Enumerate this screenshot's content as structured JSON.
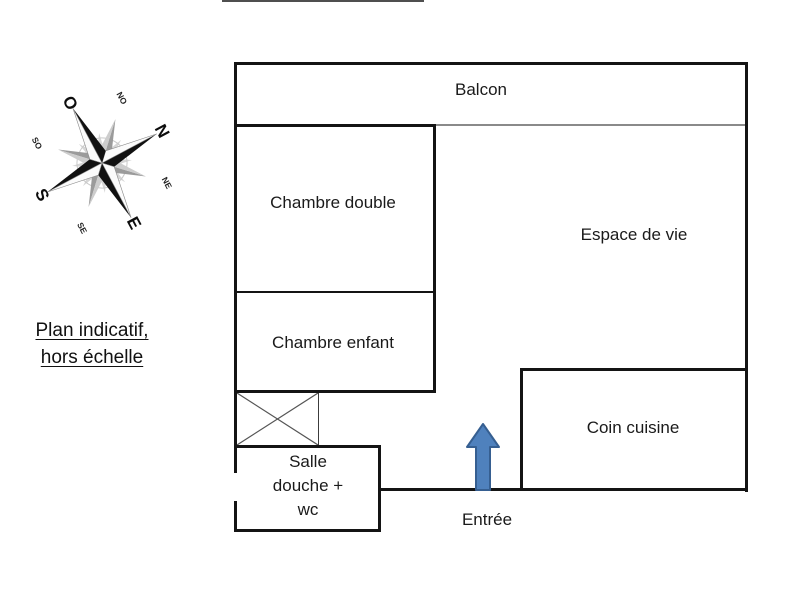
{
  "note": {
    "line1": "Plan indicatif,",
    "line2": "hors échelle"
  },
  "compass": {
    "cardinal": {
      "n": "N",
      "e": "E",
      "s": "S",
      "o": "O"
    },
    "intercardinal": {
      "no": "NO",
      "ne": "NE",
      "se": "SE",
      "so": "SO"
    }
  },
  "plan": {
    "rooms": {
      "balcon": "Balcon",
      "chambre_double": "Chambre double",
      "chambre_enfant": "Chambre enfant",
      "espace_de_vie": "Espace de vie",
      "coin_cuisine": "Coin cuisine",
      "salle_douche": {
        "line1": "Salle",
        "line2": "douche +",
        "line3": "wc"
      },
      "entree": "Entrée"
    },
    "colors": {
      "wall": "#141414",
      "balcony_divider": "#8a8a8a",
      "arrow_fill": "#4f81bd",
      "arrow_stroke": "#365f91"
    }
  }
}
